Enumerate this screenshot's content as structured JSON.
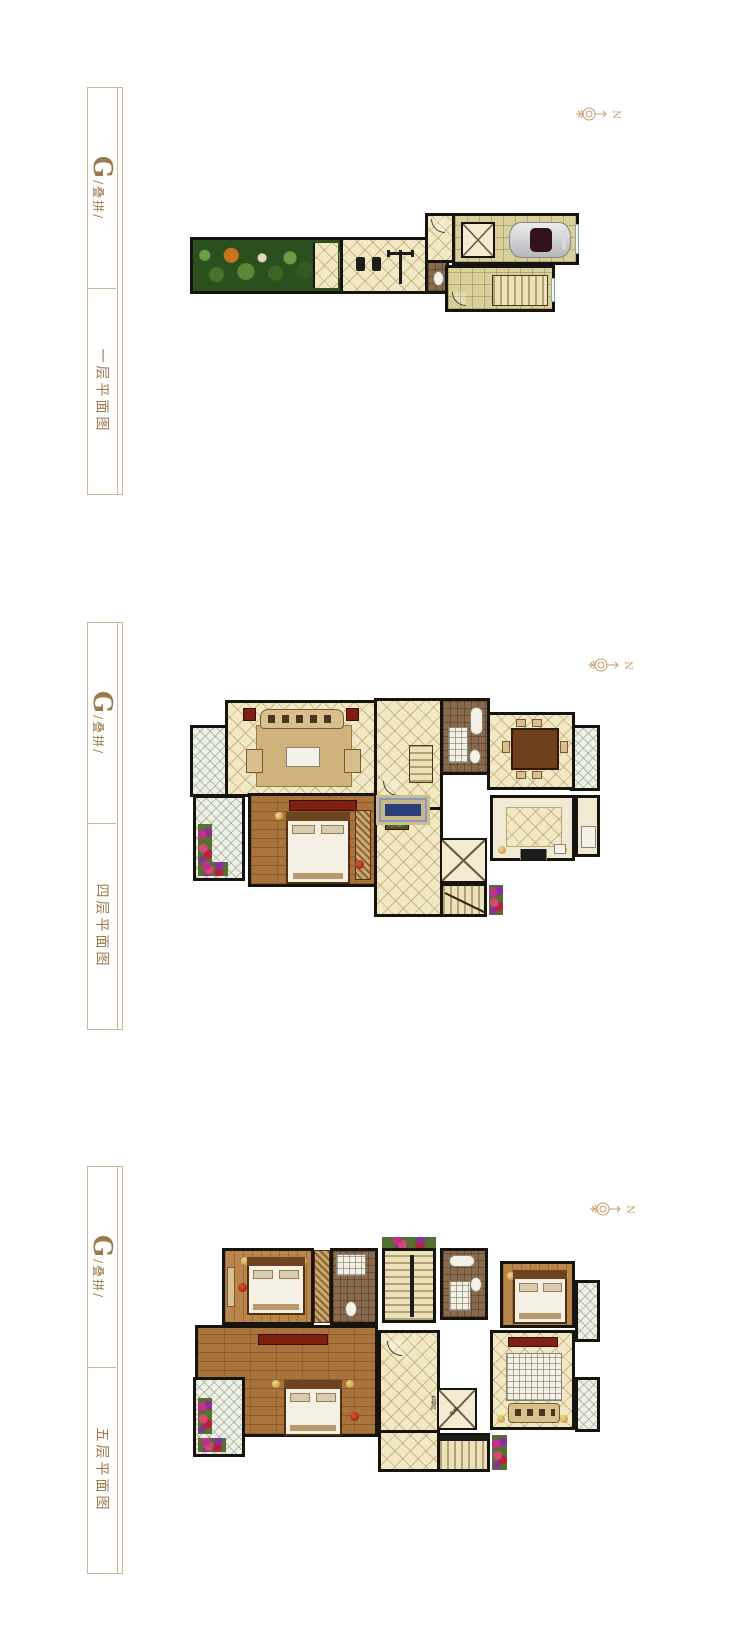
{
  "sections": [
    {
      "unit_g": "G",
      "unit_suffix": "/叠拼/",
      "floor_label": "一层平面图",
      "compass_letter": "N"
    },
    {
      "unit_g": "G",
      "unit_suffix": "/叠拼/",
      "floor_label": "四层平面图",
      "compass_letter": "N"
    },
    {
      "unit_g": "G",
      "unit_suffix": "/叠拼/",
      "floor_label": "五层平面图",
      "compass_letter": "N"
    }
  ],
  "tiny_labels": {
    "elevator": "电梯",
    "cloakroom": "衣帽间"
  },
  "colors": {
    "label_text": "#9d7950",
    "label_border": "#ccb896",
    "compass": "#c49c6a",
    "wall": "#17130e",
    "floor_cream": "#f1e8c6",
    "floor_khaki": "#d9cf9b",
    "wood": "#a8743c",
    "bath_tile": "#8a6a4c",
    "garden_green": "#2c4f1e",
    "balcony": "#eef0e4",
    "accent_red": "#7e1f12",
    "rug_blue": "#2c3f7a"
  }
}
